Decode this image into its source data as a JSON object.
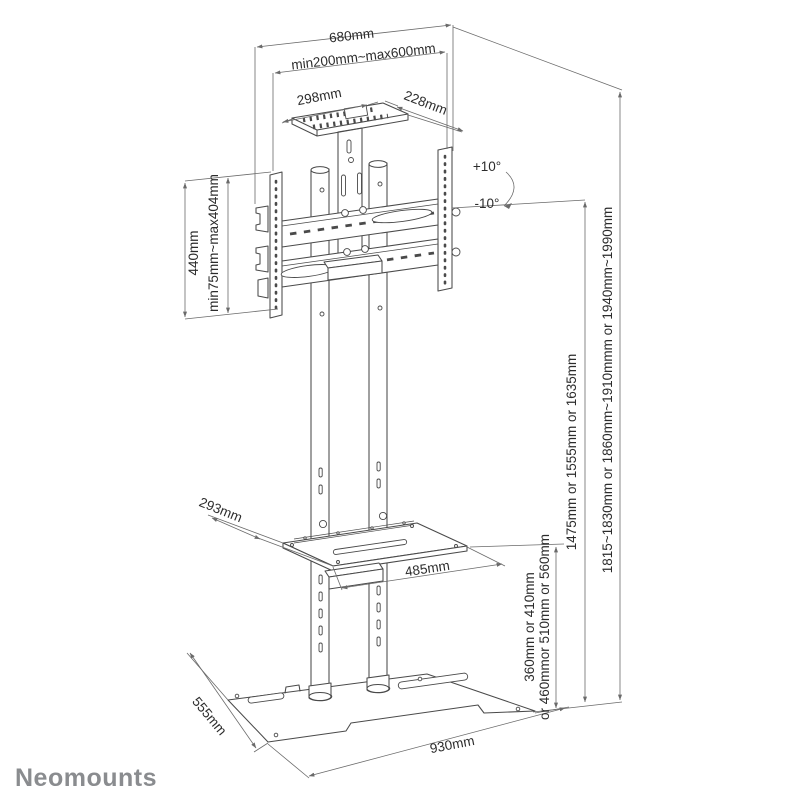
{
  "brand": "Neomounts",
  "diagram_type": "tv-floor-stand-dimension-drawing",
  "colors": {
    "drawing_line": "#4a4a4a",
    "dimension_line": "#6a6a6a",
    "label_text": "#2c2c2c",
    "brand_text": "#8a8c8f",
    "background": "#ffffff"
  },
  "labels": {
    "top_width": "680mm",
    "mount_width_range": "min200mm~max600mm",
    "top_shelf_width": "298mm",
    "top_shelf_depth": "228mm",
    "tilt_up": "+10°",
    "tilt_down": "-10°",
    "bracket_height": "440mm",
    "bracket_height_range": "min75mm~max404mm",
    "screen_center_height": "1475mm or 1555mm or 1635mm",
    "total_height": "1815~1830mm or 1860mm~1910mmm or 1940mm~1990mm",
    "shelf_height_line1": "360mm or 410mm",
    "shelf_height_line2": "or 460mmor 510mm or 560mm",
    "mid_shelf_depth": "293mm",
    "mid_shelf_width": "485mm",
    "base_depth": "555mm",
    "base_width": "930mm"
  }
}
